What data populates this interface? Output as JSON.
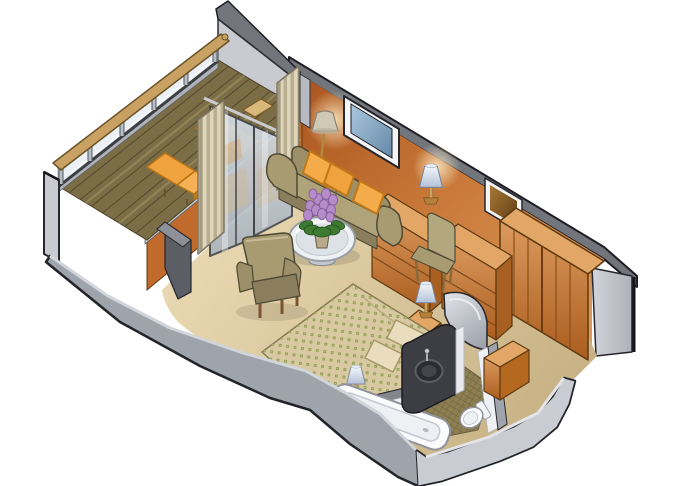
{
  "scene": {
    "type": "isometric-cutaway-floor-plan",
    "subject": "cruise-ship-stateroom-with-private-balcony",
    "background": "#ffffff"
  },
  "palette": {
    "outline": "#26262c",
    "hull_gray": "#9fa3ac",
    "hull_gray_light": "#c9ccd2",
    "wall_cut_gray": "#c9cbd1",
    "wall_band_gray": "#73757c",
    "wall_orange_dark": "#a9531d",
    "wall_orange_light": "#dd9a58",
    "wood_light": "#e2a766",
    "wood_mid": "#c87937",
    "wood_dark": "#a85f22",
    "floor_tan_light": "#ecdcb6",
    "floor_tan_dark": "#c7b184",
    "deck_olive": "#7b6d46",
    "railing_wood": "#c9a263",
    "cushion_orange": "#f0a23e",
    "upholstery_olive": "#a89b72",
    "upholstery_dark": "#8a7e5c",
    "bedspread_tan": "#d9c9a2",
    "bed_dot_green": "#8d9b4e",
    "curtain_light": "#ded5bc",
    "curtain_dark": "#b9ae90",
    "glass_blue": "#d6dee5",
    "picture_blue": "#6588a8",
    "mirror_brown": "#5e3c12",
    "lamp_shade_blue": "#b4c2d8",
    "tile_olive": "#8d7f52",
    "vanity_charcoal": "#3c3e44",
    "fixture_white": "#fbfcfd",
    "flower_purple": "#b48cc8",
    "leaf_green": "#3f7a33"
  },
  "areas": {
    "balcony": {
      "id": "balcony",
      "features": [
        "glass-railing",
        "wood-plank-deck",
        "partition-wall"
      ],
      "furniture": [
        {
          "item": "lounge-chair"
        },
        {
          "item": "lounge-chair"
        },
        {
          "item": "side-table"
        }
      ]
    },
    "living_area": {
      "id": "living-area",
      "features": [
        "sliding-glass-door",
        "striped-curtains",
        "blue-wall-picture"
      ],
      "furniture": [
        {
          "item": "sofa",
          "pillows": 3
        },
        {
          "item": "coffee-table"
        },
        {
          "item": "flower-vase"
        },
        {
          "item": "armchair"
        },
        {
          "item": "floor-lamp"
        }
      ]
    },
    "sleeping_area": {
      "id": "sleeping-area",
      "features": [
        "green-dotted-bedspread"
      ],
      "furniture": [
        {
          "item": "double-bed",
          "pillows": 2
        },
        {
          "item": "nightstand"
        },
        {
          "item": "bedside-lamp"
        },
        {
          "item": "bedside-lamp"
        }
      ]
    },
    "dressing_area": {
      "id": "dressing-area",
      "features": [
        "wall-mirror"
      ],
      "furniture": [
        {
          "item": "drawer-chest"
        },
        {
          "item": "table-lamp"
        },
        {
          "item": "desk-chest"
        },
        {
          "item": "desk-chair"
        },
        {
          "item": "wardrobe-closet"
        }
      ]
    },
    "bathroom": {
      "id": "bathroom",
      "features": [
        "tiled-floor",
        "curved-shower-wall"
      ],
      "furniture": [
        {
          "item": "bathtub"
        },
        {
          "item": "toilet"
        },
        {
          "item": "vanity-sink"
        },
        {
          "item": "cabinet"
        }
      ]
    }
  }
}
